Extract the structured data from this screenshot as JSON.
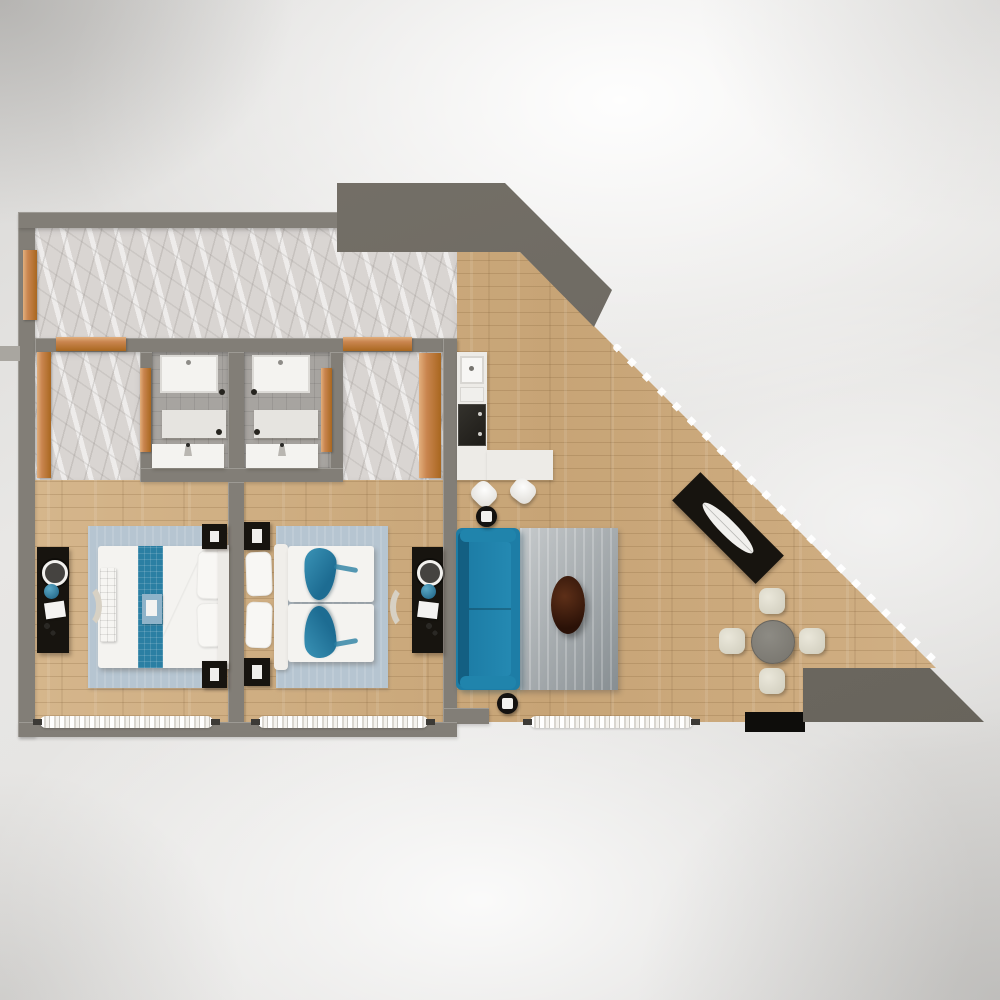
{
  "scene": {
    "type": "3d-floor-plan-top-down-render",
    "text_visible": false
  },
  "colors": {
    "wall": "#827e77",
    "wall_light": "#a9a6a0",
    "dark_block": "#6e6a63",
    "wood_light": "#d6b78d",
    "wood_mid": "#cbaa7d",
    "marble": "#d9d5d2",
    "tile": "#a7a4a0",
    "door_wood": "#c9854f",
    "door_wood_light": "#e2af7d",
    "sofa_teal": "#1d7da6",
    "sofa_teal_dark": "#135f82",
    "accent_teal": "#2b7fa3",
    "bedroom_rug": "#b6c5d1",
    "living_rug_light": "#c6cacc",
    "living_rug_dark": "#878e92",
    "coffee_table": "#3a1a0c",
    "black_furniture": "#17140f",
    "white_furniture": "#f4f3f0",
    "chair_cream": "#e0ddd0",
    "table_gray": "#85837d",
    "curtain_white": "#ffffff"
  },
  "structure": {
    "exterior": [
      "left-wall",
      "top-wall",
      "bottom-wall",
      "diagonal-glass-wall",
      "entrance-block-top",
      "exterior-block-bottom-right"
    ],
    "floors": {
      "hall": "marble",
      "closet": "marble",
      "corridor": "marble",
      "bathrooms": "gray-tile",
      "bedrooms": "wood-plank",
      "living-kitchen": "wood-plank"
    }
  },
  "rooms": [
    {
      "name": "entry-hall",
      "floor": "marble",
      "items": [
        "entry-door-wood",
        "closet-door-wood",
        "corridor-door-wood"
      ]
    },
    {
      "name": "walk-in-closet",
      "floor": "marble",
      "items": [
        "wood-door-panel"
      ]
    },
    {
      "name": "bathroom-1",
      "floor": "gray-tile",
      "items": [
        "shower-tray",
        "vanity-unit",
        "sink-counter",
        "wood-door",
        "drain-dots"
      ]
    },
    {
      "name": "bathroom-2",
      "floor": "gray-tile",
      "items": [
        "shower-tray",
        "vanity-unit",
        "sink-counter",
        "wood-door",
        "drain-dots"
      ]
    },
    {
      "name": "inner-corridor",
      "floor": "marble",
      "items": [
        "wood-door"
      ]
    },
    {
      "name": "bedroom-1",
      "floor": "wood",
      "items": [
        "light-blue-rug",
        "double-bed-white",
        "teal-bed-runner",
        "bed-tray",
        "foot-bench",
        "pillow-x2",
        "headboard",
        "nightstand-x2",
        "black-desk",
        "round-mirror",
        "teal-decor-ball",
        "laptop",
        "crescent-chair",
        "window-curtain"
      ]
    },
    {
      "name": "bedroom-2",
      "floor": "wood",
      "items": [
        "light-blue-rug",
        "twin-bed-x2",
        "teal-throw-x2",
        "pillow-x2",
        "headboard",
        "nightstand-x2",
        "black-desk",
        "round-mirror",
        "teal-decor-ball",
        "laptop",
        "crescent-chair",
        "window-curtain"
      ]
    },
    {
      "name": "kitchen",
      "floor": "wood",
      "items": [
        "l-shaped-white-counter",
        "double-sink",
        "black-cooktop",
        "bar-stool-x2"
      ]
    },
    {
      "name": "living-dining",
      "floor": "wood",
      "items": [
        "teal-sofa",
        "gray-shag-rug",
        "dark-oval-coffee-table",
        "round-side-stool-x2",
        "black-console-diagonal",
        "white-leaf-tray",
        "round-dining-table",
        "cream-dining-chair-x4",
        "black-doormat",
        "window-curtain",
        "glass-wall-curtain-dashes"
      ]
    }
  ]
}
